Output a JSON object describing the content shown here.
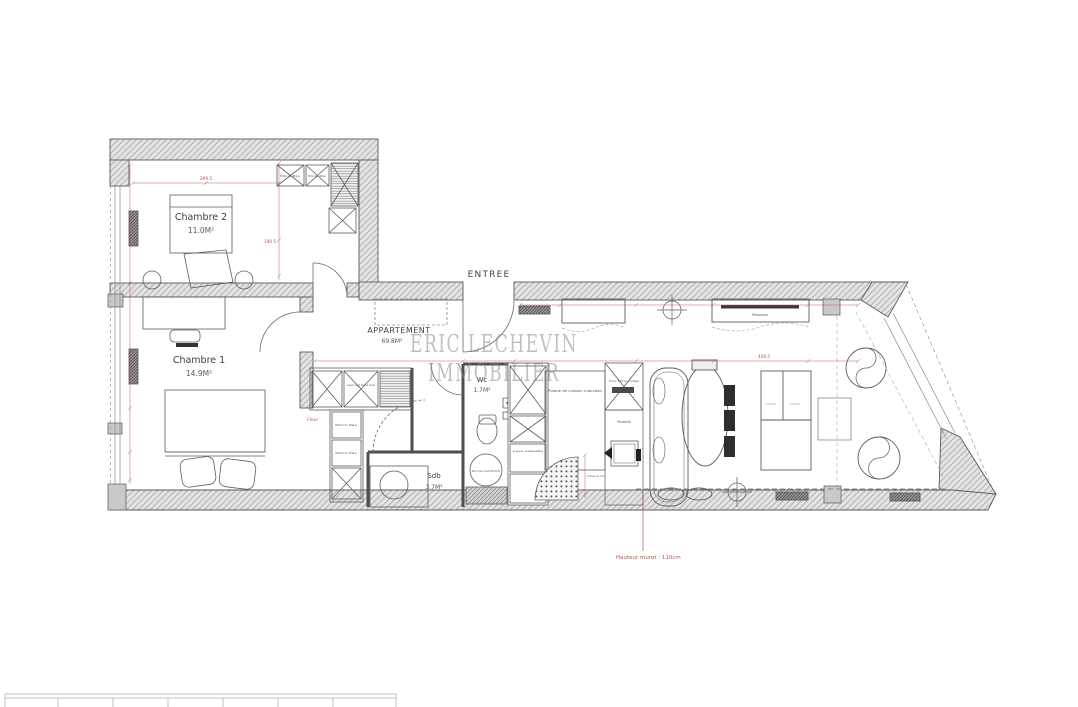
{
  "plan": {
    "watermark": {
      "line1": "ERIC LECHEVIN",
      "line2": "IMMOBILIER"
    },
    "entry": {
      "label": "ENTREE"
    },
    "apartment": {
      "name": "APPARTEMENT",
      "area": "69.8M²"
    },
    "rooms": {
      "chambre2": {
        "name": "Chambre 2",
        "area": "11.0M²"
      },
      "chambre1": {
        "name": "Chambre 1",
        "area": "14.9M²"
      },
      "wc": {
        "name": "Wc",
        "area": "1.7M²"
      },
      "sdb": {
        "name": "Sdb",
        "area": "3.7M²"
      }
    },
    "labels": {
      "television": "Television",
      "poubelle": "Poubelle",
      "lave_vaisselle": "Lave vaisselle",
      "plaque_cuisson": "Plaque de cuisson induction",
      "ballon": "Ballon d'eau chaude 200L 50/50",
      "lave_linge": "Lave Linge Sèche linge",
      "pax_a": "50cm Pax",
      "pax_b": "50cm Pax",
      "pax_c": "50cm Pax",
      "pax_d": "50cm Pax",
      "four": "Four Micro-ondes",
      "cave_vin": "Cave à vin",
      "fleur": "Fleur",
      "muret_note": "Hauteur muret : 110cm"
    },
    "dimensions": {
      "d1": "299.5",
      "d2": "190.5",
      "d3": "408.5"
    },
    "colors": {
      "dimension_red": "#b0554c",
      "wall_fill": "#e4e4e4",
      "line": "#555555",
      "watermark_gray": "#838383"
    }
  }
}
